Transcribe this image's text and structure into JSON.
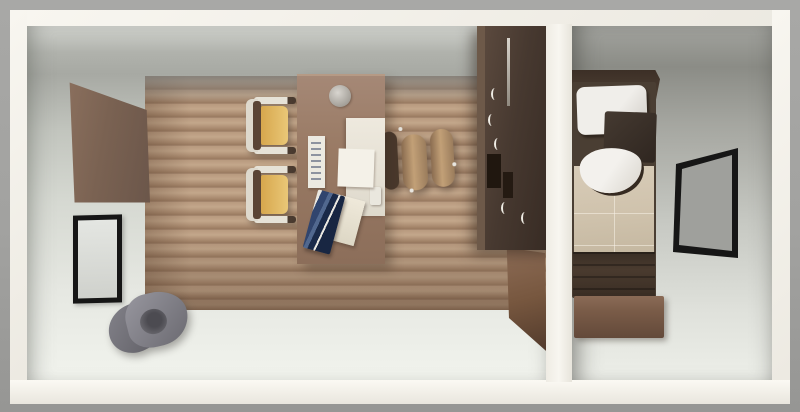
{
  "scene": {
    "description": "Top-down 3D rendered floor plan of a two-room suite: an office/living area on the left and a bedroom on the right, separated by a white partition wall",
    "view": "top-down 3D render",
    "rooms": [
      {
        "name": "Office / living area"
      },
      {
        "name": "Bedroom"
      }
    ],
    "colors": {
      "background": "#a0a09e",
      "walls": "#f3f1ea",
      "office_floor": "#dfe2db",
      "wood_floor": "#b29378",
      "bedroom_floor": "#cfd1cb",
      "window_frame": "#161616",
      "guest_chair_seat": "#dfb35a",
      "wardrobe": "#3f3129",
      "duvet": "#d2c5af"
    }
  },
  "furniture": {
    "office_floor": {
      "label": "Office floor (light surface)",
      "color": "#dfe2db"
    },
    "wood_floor": {
      "label": "Hardwood plank flooring",
      "color": "#b29378"
    },
    "wall_wood_panel": {
      "label": "Wood panel on left wall",
      "color": "#7c6353"
    },
    "left_window": {
      "label": "Black-framed window on left wall",
      "frame_color": "#161616",
      "glass_color": "#d9dbd7"
    },
    "lounge_chair": {
      "label": "Gray lounge chair in corner",
      "color": "#84838a"
    },
    "desk": {
      "label": "Wooden desk",
      "color": "#96775f"
    },
    "desk_plate": {
      "label": "Round tray on desk",
      "color": "#b5b1aa"
    },
    "desk_pad": {
      "label": "White desk pad",
      "color": "#e9e5da"
    },
    "paper_sheet": {
      "label": "Paper sheet on desk",
      "color": "#f4f1e8"
    },
    "brochure_stand": {
      "label": "Brochure stand with printed card",
      "color": "#eceae1"
    },
    "blue_folder": {
      "label": "Navy blue folder",
      "color": "#24355a"
    },
    "notepad": {
      "label": "Cream notepad",
      "color": "#e6e1d3"
    },
    "guest_chair_1": {
      "label": "Guest chair with yellow seat (upper)",
      "seat_color": "#dfb35a",
      "back_color": "#5a4435",
      "frame_color": "#ded9cd"
    },
    "guest_chair_2": {
      "label": "Guest chair with yellow seat (lower)",
      "seat_color": "#dfb35a",
      "back_color": "#5a4435",
      "frame_color": "#ded9cd"
    },
    "task_chair": {
      "label": "Office task chair",
      "back_color": "#4a392c",
      "armrest_color": "#b2906a"
    },
    "wardrobe": {
      "label": "Dark wardrobe / minibar cabinet",
      "color": "#3f3129"
    },
    "door_panel": {
      "label": "Open wooden door on partition wall",
      "color": "#77573f"
    },
    "bedroom_floor": {
      "label": "Bedroom floor",
      "color": "#cfd1cb"
    },
    "headboard": {
      "label": "Bed headboard",
      "color": "#473a2e"
    },
    "bed_frame": {
      "label": "Single bed frame",
      "color": "#4a3e33"
    },
    "pillow_top": {
      "label": "White pillow at head of bed",
      "color": "#efede9"
    },
    "dark_cushion": {
      "label": "Dark brown cushion",
      "color": "#39302a"
    },
    "pillow_mid": {
      "label": "White pillow with dark trim",
      "color": "#f1efeb"
    },
    "duvet": {
      "label": "Beige duvet with seams",
      "color": "#d2c5af"
    },
    "footboard": {
      "label": "Bed footboard",
      "color": "#41352b"
    },
    "bench": {
      "label": "Bench at foot of bed",
      "color": "#75594a"
    },
    "right_window": {
      "label": "Black-framed window on right wall",
      "frame_color": "#161616",
      "glass_color": "#9fa09c"
    }
  },
  "structure": {
    "wall_top": {
      "label": "Top exterior wall"
    },
    "wall_left": {
      "label": "Left exterior wall"
    },
    "wall_right": {
      "label": "Right exterior wall"
    },
    "wall_bottom": {
      "label": "Bottom exterior wall"
    },
    "wall_divider": {
      "label": "Partition wall between office and bedroom"
    }
  }
}
